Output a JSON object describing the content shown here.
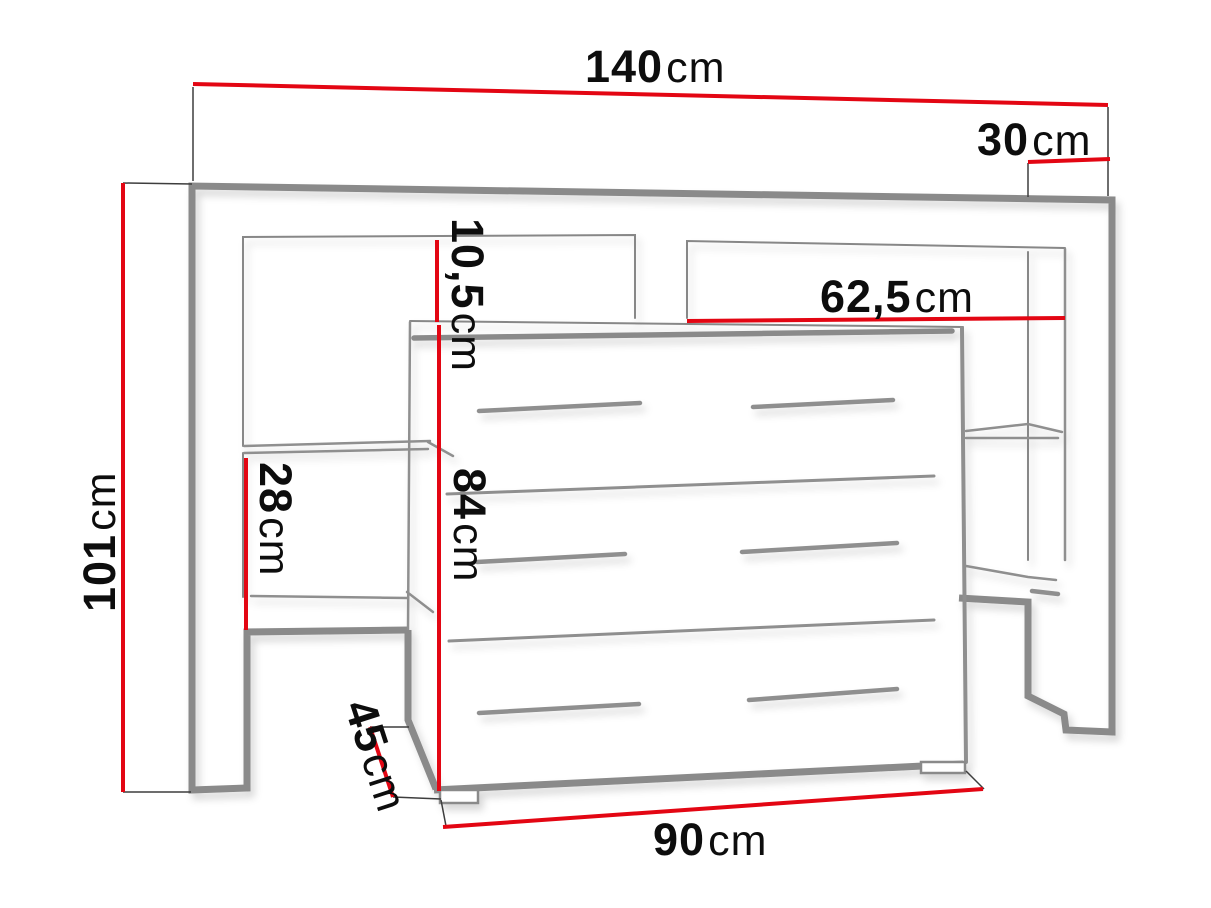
{
  "diagram": {
    "kind": "furniture-dimension-drawing",
    "subject": "headboard bridge unit with shelf niches and 3-drawer chest"
  },
  "dimensions": {
    "total_width": {
      "value": "140",
      "unit": "cm"
    },
    "side_depth": {
      "value": "30",
      "unit": "cm"
    },
    "total_height": {
      "value": "101",
      "unit": "cm"
    },
    "niche_width": {
      "value": "62,5",
      "unit": "cm"
    },
    "top_gap": {
      "value": "10,5",
      "unit": "cm"
    },
    "shelf_space": {
      "value": "28",
      "unit": "cm"
    },
    "chest_height": {
      "value": "84",
      "unit": "cm"
    },
    "chest_depth": {
      "value": "45",
      "unit": "cm"
    },
    "chest_width": {
      "value": "90",
      "unit": "cm"
    }
  },
  "colors": {
    "dimension_line": "#e30613",
    "furniture_outline": "#8a8a8a",
    "text": "#0d0d0d",
    "background": "#ffffff"
  }
}
